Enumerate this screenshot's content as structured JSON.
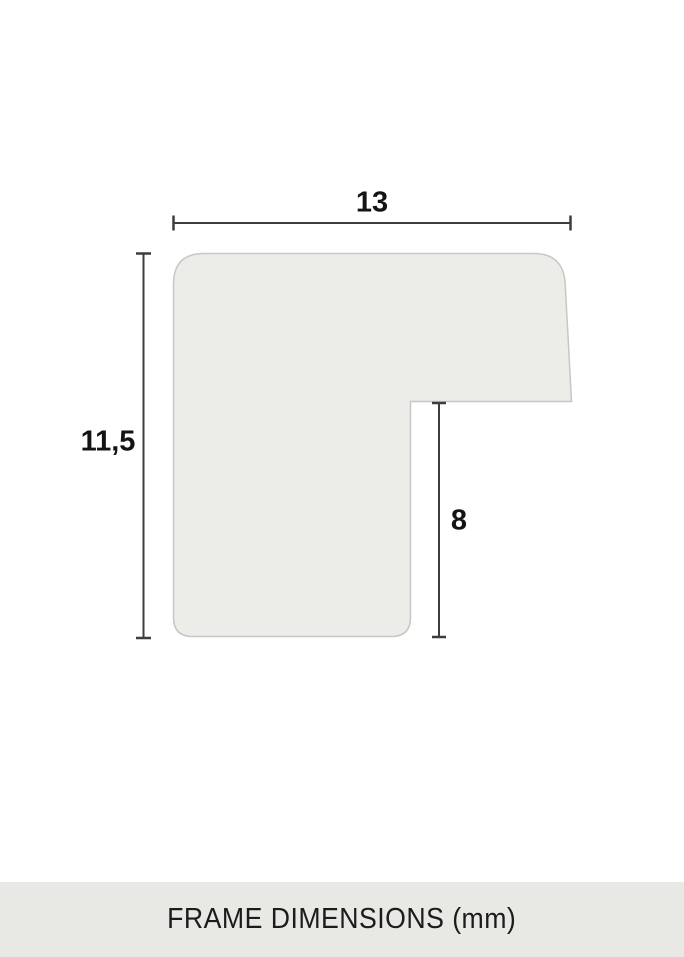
{
  "diagram": {
    "type": "frame-profile-cross-section",
    "caption": "FRAME DIMENSIONS (mm)",
    "unit": "mm",
    "dimensions": {
      "width": {
        "label": "13",
        "value": 13,
        "orientation": "horizontal",
        "description": "total profile width"
      },
      "height": {
        "label": "11,5",
        "value": 11.5,
        "orientation": "vertical",
        "description": "total profile height"
      },
      "rabbet": {
        "label": "8",
        "value": 8,
        "orientation": "vertical",
        "description": "rabbet depth"
      }
    }
  },
  "colors": {
    "background": "#ffffff",
    "shape_fill": "#ececE9",
    "shape_stroke": "#c7c7c4",
    "dimension_line": "#3d3d3d",
    "caption_bg": "#e8e8e4",
    "text": "#141414"
  }
}
